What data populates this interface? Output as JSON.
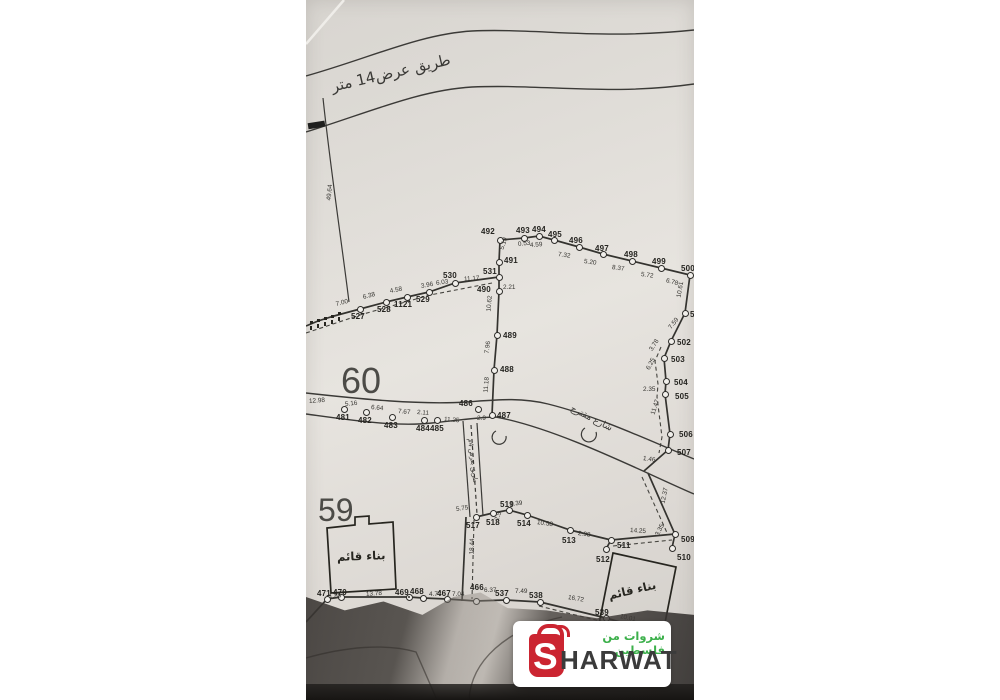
{
  "map": {
    "top_road_label": "طريق عرض14 متر",
    "street_label": "شارع مقترح",
    "lane_label": "طريق بعرض 4م",
    "parcel_60": "60",
    "parcel_59": "59",
    "building_label_1": "بناء قائم",
    "building_label_2": "بناء قائم",
    "points": [
      {
        "n": "527",
        "x": 360,
        "y": 309,
        "lx": 351,
        "ly": 312
      },
      {
        "n": "528",
        "x": 386,
        "y": 302,
        "lx": 377,
        "ly": 305
      },
      {
        "n": "1121",
        "x": 407,
        "y": 297,
        "lx": 394,
        "ly": 300
      },
      {
        "n": "529",
        "x": 429,
        "y": 292,
        "lx": 416,
        "ly": 295
      },
      {
        "n": "530",
        "x": 455,
        "y": 283,
        "lx": 443,
        "ly": 271
      },
      {
        "n": "531",
        "x": 499,
        "y": 277,
        "lx": 483,
        "ly": 267
      },
      {
        "n": "490",
        "x": 499,
        "y": 291,
        "lx": 477,
        "ly": 285
      },
      {
        "n": "492",
        "x": 500,
        "y": 240,
        "lx": 481,
        "ly": 227
      },
      {
        "n": "491",
        "x": 499,
        "y": 262,
        "lx": 504,
        "ly": 256
      },
      {
        "n": "493",
        "x": 524,
        "y": 238,
        "lx": 516,
        "ly": 226
      },
      {
        "n": "494",
        "x": 539,
        "y": 236,
        "lx": 532,
        "ly": 225
      },
      {
        "n": "495",
        "x": 554,
        "y": 240,
        "lx": 548,
        "ly": 230
      },
      {
        "n": "496",
        "x": 579,
        "y": 247,
        "lx": 569,
        "ly": 236
      },
      {
        "n": "497",
        "x": 603,
        "y": 254,
        "lx": 595,
        "ly": 244
      },
      {
        "n": "498",
        "x": 632,
        "y": 261,
        "lx": 624,
        "ly": 250
      },
      {
        "n": "499",
        "x": 661,
        "y": 268,
        "lx": 652,
        "ly": 257
      },
      {
        "n": "500",
        "x": 690,
        "y": 275,
        "lx": 681,
        "ly": 264
      },
      {
        "n": "501",
        "x": 685,
        "y": 313,
        "lx": 690,
        "ly": 310
      },
      {
        "n": "502",
        "x": 671,
        "y": 341,
        "lx": 677,
        "ly": 338
      },
      {
        "n": "503",
        "x": 664,
        "y": 358,
        "lx": 671,
        "ly": 355
      },
      {
        "n": "504",
        "x": 666,
        "y": 381,
        "lx": 674,
        "ly": 378
      },
      {
        "n": "505",
        "x": 665,
        "y": 394,
        "lx": 675,
        "ly": 392
      },
      {
        "n": "506",
        "x": 670,
        "y": 434,
        "lx": 679,
        "ly": 430
      },
      {
        "n": "507",
        "x": 668,
        "y": 450,
        "lx": 677,
        "ly": 448
      },
      {
        "n": "489",
        "x": 497,
        "y": 335,
        "lx": 503,
        "ly": 331
      },
      {
        "n": "488",
        "x": 494,
        "y": 370,
        "lx": 500,
        "ly": 365
      },
      {
        "n": "487",
        "x": 492,
        "y": 415,
        "lx": 497,
        "ly": 411
      },
      {
        "n": "486",
        "x": 478,
        "y": 409,
        "lx": 459,
        "ly": 399
      },
      {
        "n": "481",
        "x": 344,
        "y": 409,
        "lx": 336,
        "ly": 413
      },
      {
        "n": "482",
        "x": 366,
        "y": 412,
        "lx": 358,
        "ly": 416
      },
      {
        "n": "483",
        "x": 392,
        "y": 417,
        "lx": 384,
        "ly": 421
      },
      {
        "n": "484",
        "x": 424,
        "y": 420,
        "lx": 416,
        "ly": 424
      },
      {
        "n": "485",
        "x": 437,
        "y": 420,
        "lx": 430,
        "ly": 424
      },
      {
        "n": "517",
        "x": 476,
        "y": 517,
        "lx": 466,
        "ly": 521
      },
      {
        "n": "518",
        "x": 493,
        "y": 513,
        "lx": 486,
        "ly": 518
      },
      {
        "n": "519",
        "x": 509,
        "y": 510,
        "lx": 500,
        "ly": 500
      },
      {
        "n": "514",
        "x": 527,
        "y": 515,
        "lx": 517,
        "ly": 519
      },
      {
        "n": "513",
        "x": 570,
        "y": 530,
        "lx": 562,
        "ly": 536
      },
      {
        "n": "511",
        "x": 611,
        "y": 540,
        "lx": 617,
        "ly": 541
      },
      {
        "n": "512",
        "x": 606,
        "y": 549,
        "lx": 596,
        "ly": 555
      },
      {
        "n": "509",
        "x": 675,
        "y": 534,
        "lx": 681,
        "ly": 535
      },
      {
        "n": "510",
        "x": 672,
        "y": 548,
        "lx": 677,
        "ly": 553
      },
      {
        "n": "471",
        "x": 327,
        "y": 599,
        "lx": 317,
        "ly": 589
      },
      {
        "n": "470",
        "x": 341,
        "y": 597,
        "lx": 333,
        "ly": 588
      },
      {
        "n": "469",
        "x": 409,
        "y": 597,
        "lx": 395,
        "ly": 588,
        "t": "crossed"
      },
      {
        "n": "468",
        "x": 423,
        "y": 598,
        "lx": 410,
        "ly": 587
      },
      {
        "n": "467",
        "x": 447,
        "y": 599,
        "lx": 437,
        "ly": 589
      },
      {
        "n": "466",
        "x": 476,
        "y": 601,
        "lx": 470,
        "ly": 583
      },
      {
        "n": "537",
        "x": 506,
        "y": 600,
        "lx": 495,
        "ly": 589
      },
      {
        "n": "538",
        "x": 540,
        "y": 602,
        "lx": 529,
        "ly": 591
      },
      {
        "n": "539",
        "x": 606,
        "y": 618,
        "lx": 595,
        "ly": 608
      }
    ],
    "distances": [
      {
        "v": "7.00",
        "x": 336,
        "y": 301,
        "r": -14
      },
      {
        "v": "6.38",
        "x": 363,
        "y": 294,
        "r": -14
      },
      {
        "v": "4.58",
        "x": 390,
        "y": 288,
        "r": -12
      },
      {
        "v": "3.96",
        "x": 421,
        "y": 283,
        "r": -10
      },
      {
        "v": "6.03",
        "x": 436,
        "y": 280,
        "r": -8
      },
      {
        "v": "11.17",
        "x": 464,
        "y": 276,
        "r": -4
      },
      {
        "v": "5.19",
        "x": 502,
        "y": 246,
        "r": -72
      },
      {
        "v": "2.21",
        "x": 503,
        "y": 284,
        "r": 0
      },
      {
        "v": "10.62",
        "x": 489,
        "y": 308,
        "r": -85
      },
      {
        "v": "7.96",
        "x": 487,
        "y": 350,
        "r": -82
      },
      {
        "v": "11.18",
        "x": 486,
        "y": 389,
        "r": -85
      },
      {
        "v": "0.53",
        "x": 518,
        "y": 241,
        "r": -6
      },
      {
        "v": "4.59",
        "x": 530,
        "y": 242,
        "r": -4
      },
      {
        "v": "7.32",
        "x": 558,
        "y": 251,
        "r": 8
      },
      {
        "v": "5.20",
        "x": 584,
        "y": 258,
        "r": 8
      },
      {
        "v": "8.37",
        "x": 612,
        "y": 264,
        "r": 8
      },
      {
        "v": "5.72",
        "x": 641,
        "y": 271,
        "r": 8
      },
      {
        "v": "6.78",
        "x": 666,
        "y": 277,
        "r": 16
      },
      {
        "v": "10.61",
        "x": 679,
        "y": 294,
        "r": -80
      },
      {
        "v": "7.59",
        "x": 670,
        "y": 325,
        "r": -52
      },
      {
        "v": "3.78",
        "x": 651,
        "y": 347,
        "r": -58
      },
      {
        "v": "6.25",
        "x": 648,
        "y": 366,
        "r": -62
      },
      {
        "v": "2.35",
        "x": 643,
        "y": 386,
        "r": 0
      },
      {
        "v": "11.47",
        "x": 653,
        "y": 411,
        "r": -72
      },
      {
        "v": "1.46",
        "x": 643,
        "y": 455,
        "r": 8
      },
      {
        "v": "12.37",
        "x": 663,
        "y": 500,
        "r": -78
      },
      {
        "v": "3.35",
        "x": 657,
        "y": 532,
        "r": -62
      },
      {
        "v": "14.25",
        "x": 630,
        "y": 527,
        "r": 4
      },
      {
        "v": "12.98",
        "x": 309,
        "y": 398,
        "r": -4
      },
      {
        "v": "5.16",
        "x": 345,
        "y": 401,
        "r": -6
      },
      {
        "v": "6.64",
        "x": 371,
        "y": 404,
        "r": 6
      },
      {
        "v": "7.67",
        "x": 398,
        "y": 408,
        "r": 5
      },
      {
        "v": "2.11",
        "x": 417,
        "y": 409,
        "r": 5
      },
      {
        "v": "11.25",
        "x": 444,
        "y": 416,
        "r": 5
      },
      {
        "v": "2.9",
        "x": 477,
        "y": 415,
        "r": 0
      },
      {
        "v": "5.75",
        "x": 456,
        "y": 506,
        "r": -8
      },
      {
        "v": "1.39",
        "x": 510,
        "y": 501,
        "r": -6
      },
      {
        "v": "2.5",
        "x": 497,
        "y": 517,
        "r": -72
      },
      {
        "v": "10.58",
        "x": 537,
        "y": 519,
        "r": 8
      },
      {
        "v": "2.98",
        "x": 578,
        "y": 530,
        "r": 8
      },
      {
        "v": "18.44",
        "x": 472,
        "y": 551,
        "r": -88
      },
      {
        "v": "49.64",
        "x": 329,
        "y": 197,
        "r": -84
      },
      {
        "v": "1.85",
        "x": 329,
        "y": 593,
        "r": -4
      },
      {
        "v": "13.78",
        "x": 366,
        "y": 591,
        "r": -4
      },
      {
        "v": "4.77",
        "x": 429,
        "y": 591,
        "r": 0
      },
      {
        "v": "7.04",
        "x": 452,
        "y": 591,
        "r": 0
      },
      {
        "v": "6.37",
        "x": 484,
        "y": 587,
        "r": 0
      },
      {
        "v": "7.49",
        "x": 515,
        "y": 588,
        "r": 0
      },
      {
        "v": "16.72",
        "x": 568,
        "y": 594,
        "r": 10
      },
      {
        "v": "10.01",
        "x": 620,
        "y": 613,
        "r": 12
      }
    ]
  },
  "logo": {
    "brand_s": "S",
    "brand_rest": "HARWAT",
    "tagline_ar": "شروات من فلسطين",
    "accent_red": "#cb2531",
    "accent_green": "#3cb04b"
  }
}
